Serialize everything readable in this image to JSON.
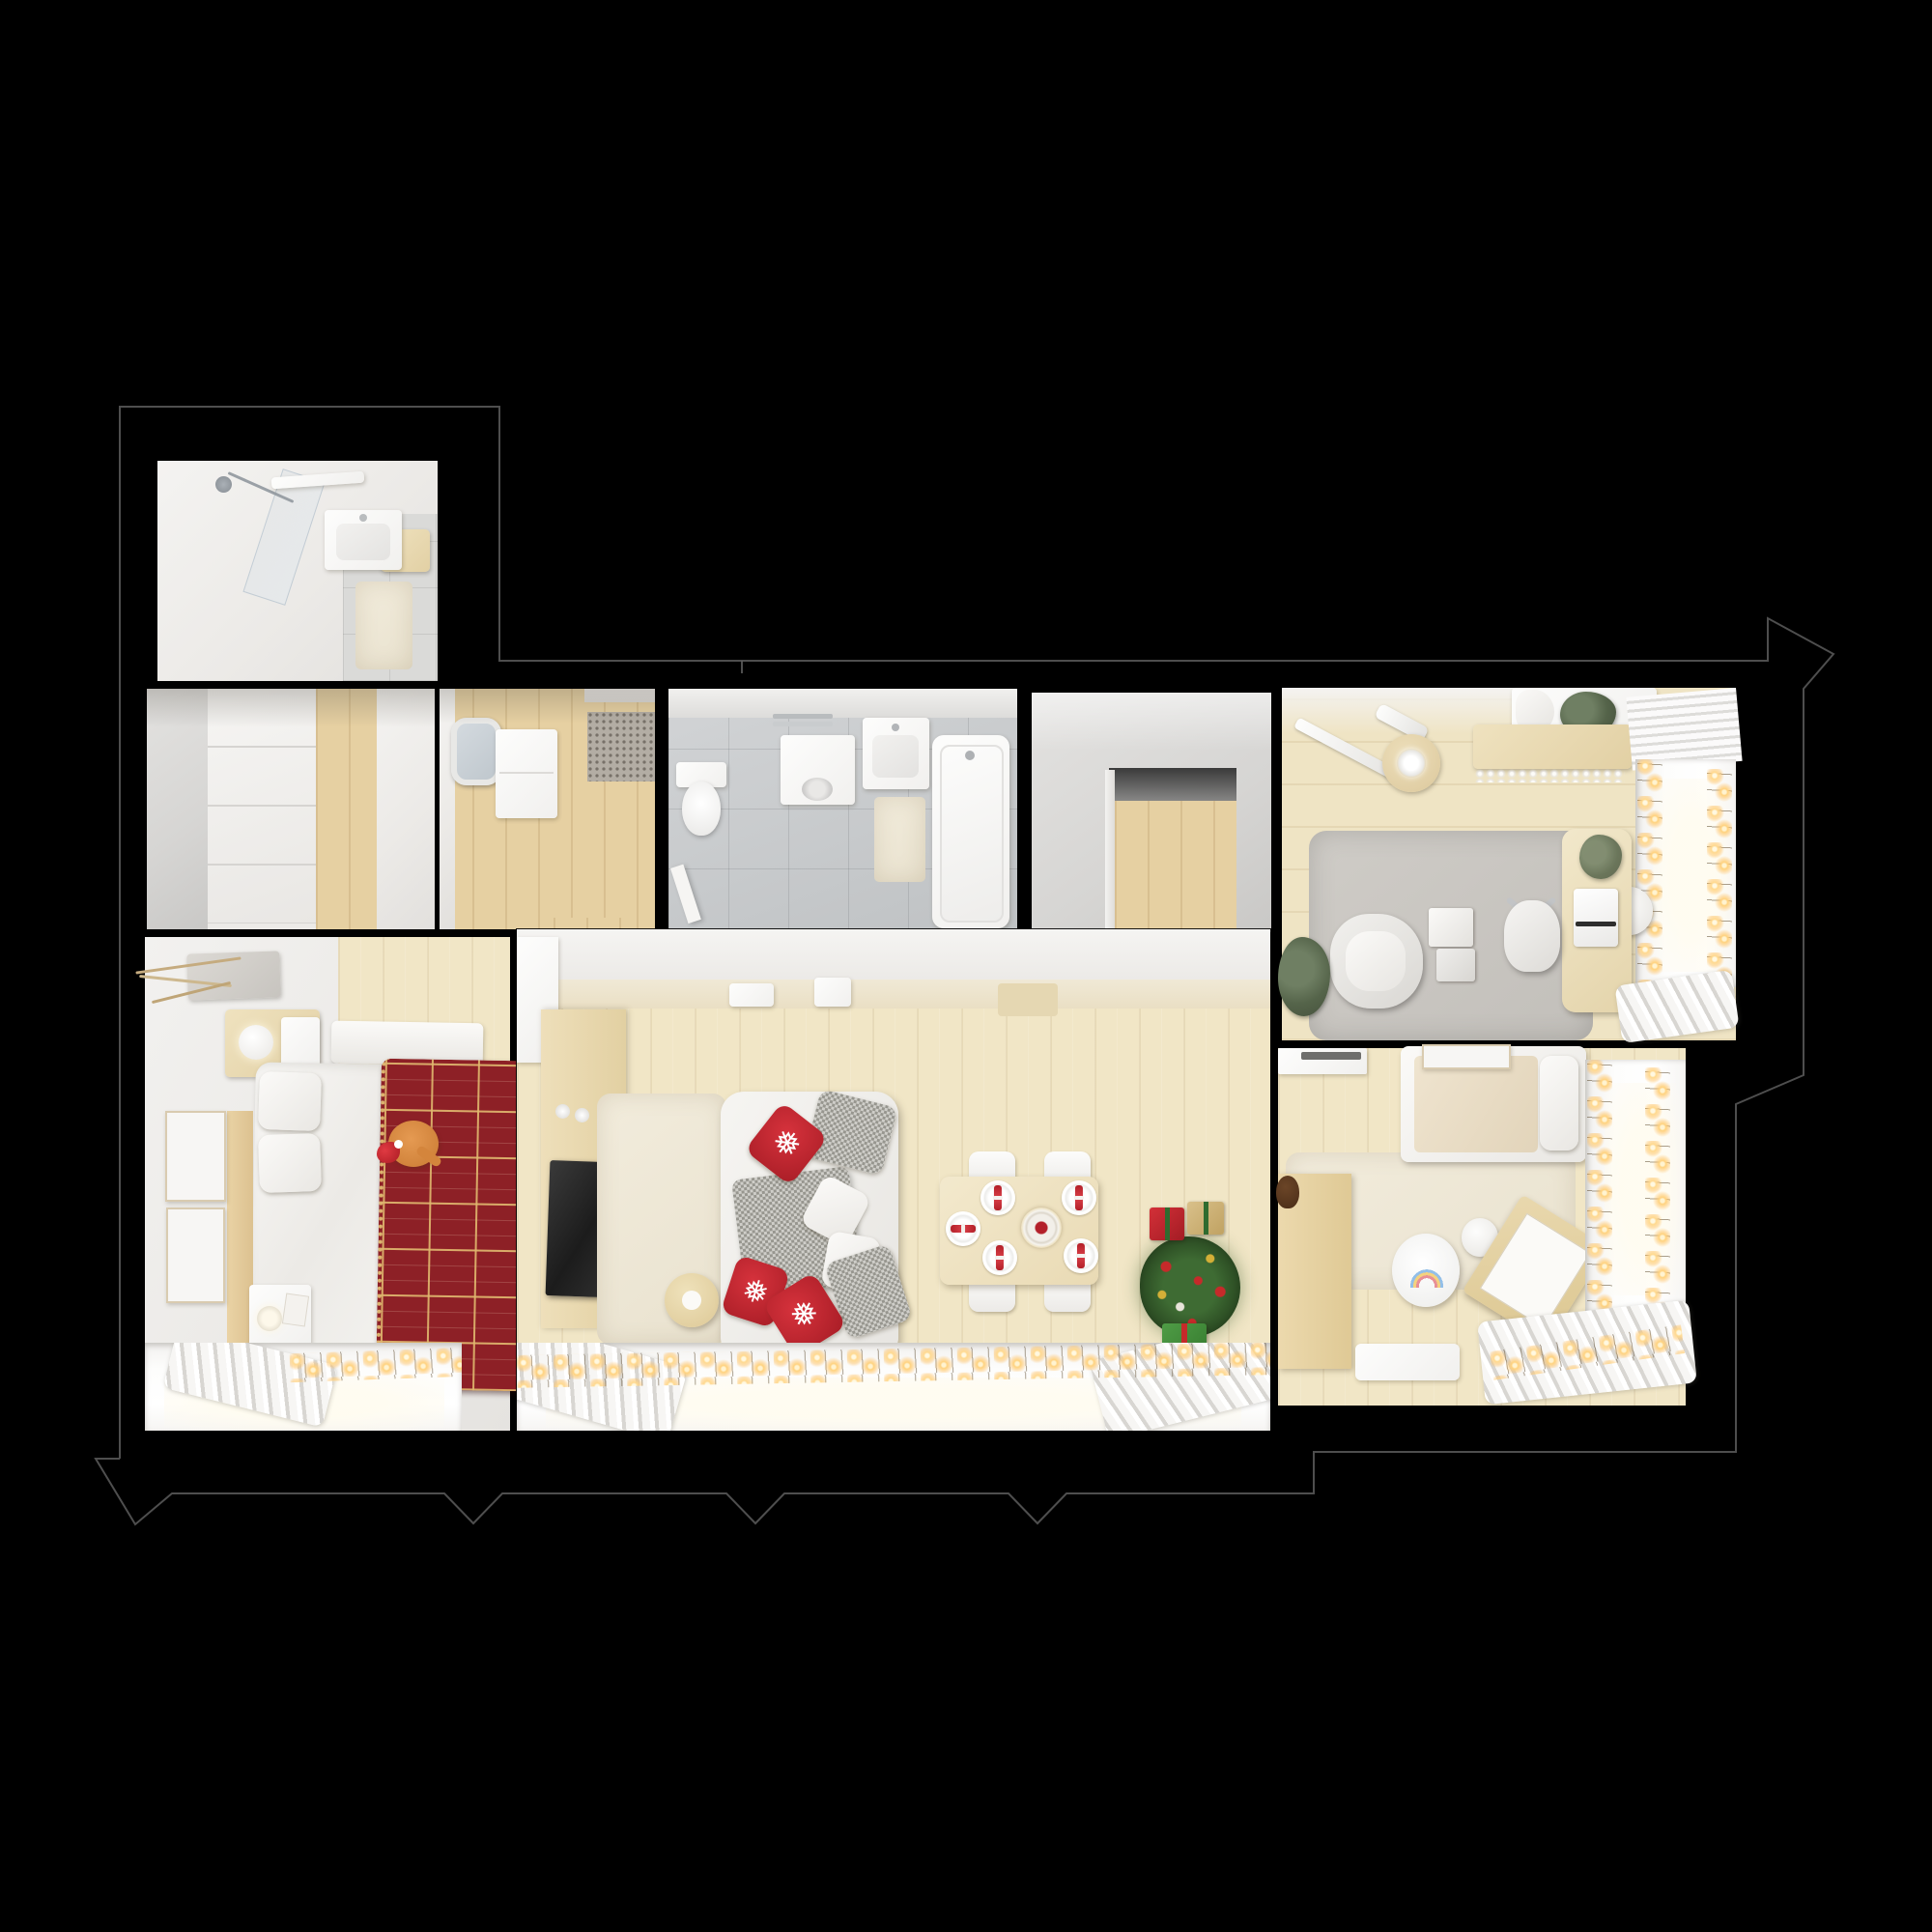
{
  "scene": {
    "type": "3d-floor-plan-top-down-render",
    "theme": "christmas-decorated-apartment",
    "background": "#000000",
    "visible_text": "none"
  },
  "palette": {
    "outline": "#5c5c5c",
    "wall_white": "#f3f2f0",
    "wall_gray": "#d9d8d6",
    "wood_light": "#f1e6c6",
    "wood_warm": "#e6d0a2",
    "tile_gray": "#c6c9cb",
    "rug_cream": "#efe9d9",
    "rug_gray": "#c9c6c1",
    "blanket_red": "#8d2026",
    "plaid_gold": "#dcb26e",
    "pillow_red": "#c0232e",
    "tree_green": "#2f5226",
    "string_lights_gold": "#ffd98f",
    "cat_orange": "#dd8f46"
  },
  "icons": {
    "snowflake": "❅",
    "sparkle": "✦"
  },
  "rooms": {
    "shower_room": {
      "name": "shower-room"
    },
    "wardrobe_room": {
      "name": "wardrobe-room"
    },
    "hallway": {
      "name": "entry-hallway"
    },
    "bathroom": {
      "name": "bathroom"
    },
    "kitchen_entry": {
      "name": "kitchen-entry-room"
    },
    "office": {
      "name": "home-office"
    },
    "bedroom": {
      "name": "bedroom"
    },
    "living_room": {
      "name": "living-dining-room"
    },
    "kids_room": {
      "name": "kids-room"
    }
  }
}
